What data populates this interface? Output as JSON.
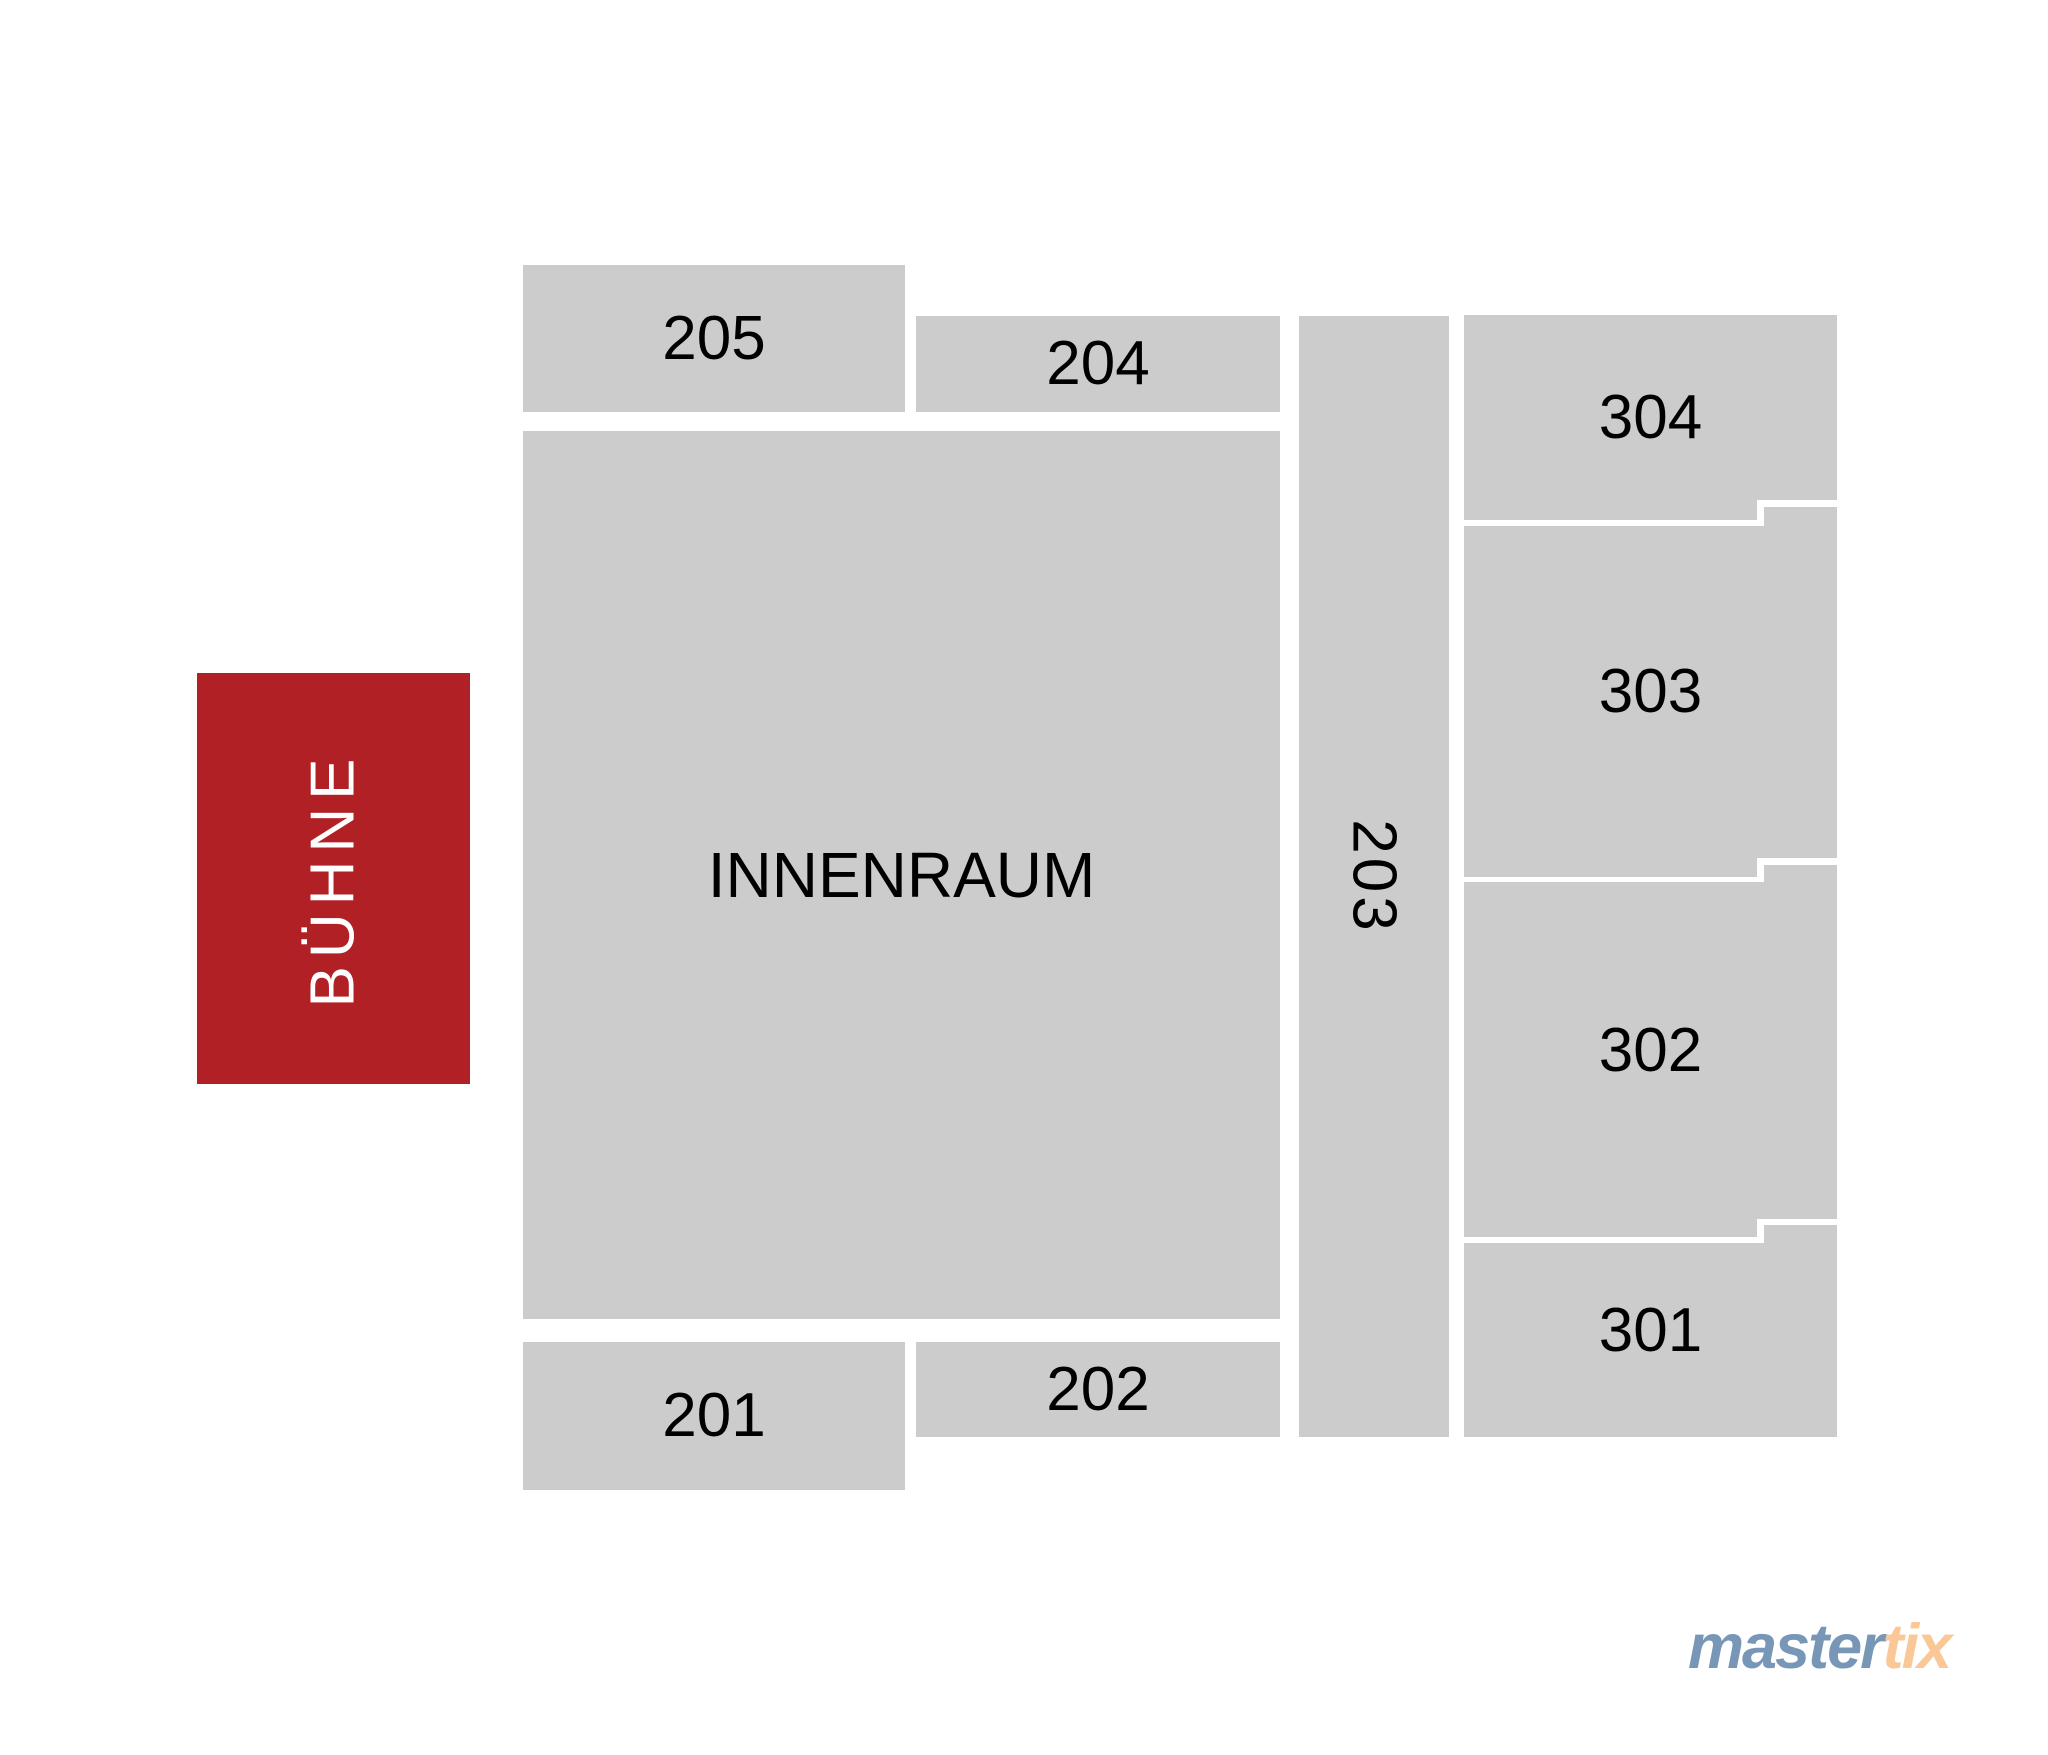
{
  "stage": {
    "label": "BÜHNE",
    "fill_color": "#b12025",
    "text_color": "#ffffff"
  },
  "sections": {
    "innenraum": {
      "label": "INNENRAUM"
    },
    "s201": {
      "label": "201"
    },
    "s202": {
      "label": "202"
    },
    "s203": {
      "label": "203"
    },
    "s204": {
      "label": "204"
    },
    "s205": {
      "label": "205"
    },
    "s301": {
      "label": "301"
    },
    "s302": {
      "label": "302"
    },
    "s303": {
      "label": "303"
    },
    "s304": {
      "label": "304"
    }
  },
  "colors": {
    "section_fill": "#cccccc",
    "section_label": "#000000",
    "background": "#ffffff"
  },
  "logo": {
    "master": "master",
    "tix": "tix",
    "master_color": "#7897b6",
    "tix_color": "#fac896"
  }
}
